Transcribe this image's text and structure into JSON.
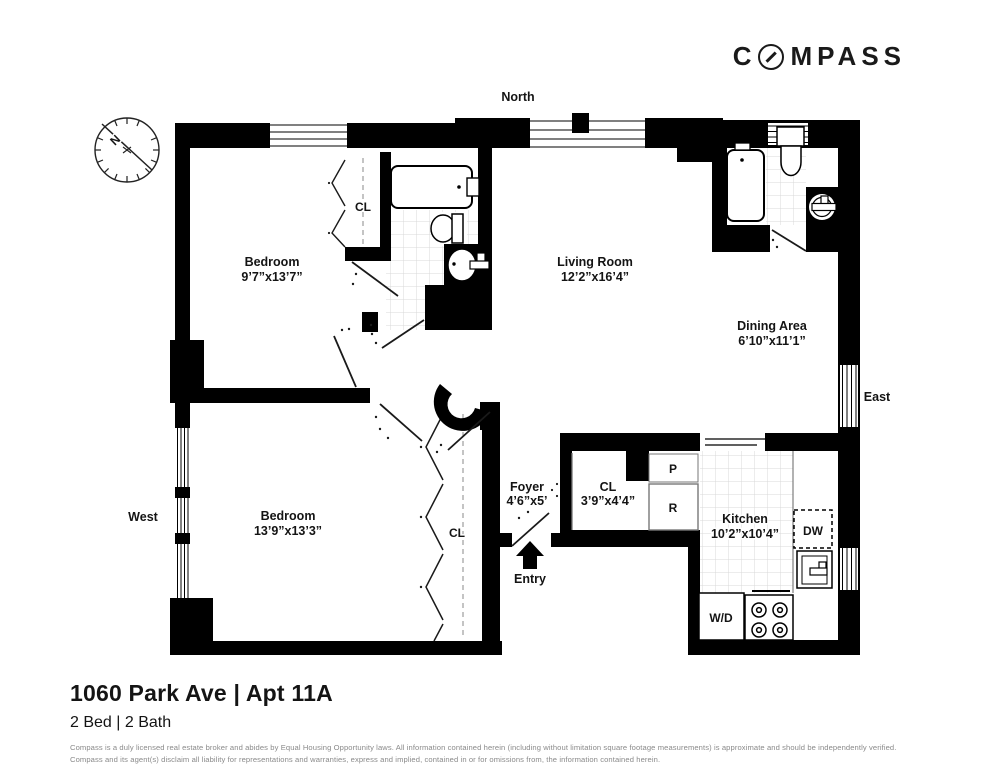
{
  "logo": {
    "part1": "C",
    "part2": "MPASS"
  },
  "plan": {
    "compass_rose": {
      "n": "N"
    },
    "directions": {
      "north": "North",
      "east": "East",
      "west": "West"
    },
    "rooms": {
      "bedroom1": {
        "name": "Bedroom",
        "dims": "9’7”x13’7”"
      },
      "bedroom2": {
        "name": "Bedroom",
        "dims": "13’9”x13’3”"
      },
      "living_room": {
        "name": "Living Room",
        "dims": "12’2”x16’4”"
      },
      "dining_area": {
        "name": "Dining Area",
        "dims": "6’10”x11’1”"
      },
      "kitchen": {
        "name": "Kitchen",
        "dims": "10’2”x10’4”"
      },
      "foyer": {
        "name": "Foyer",
        "dims": "4’6”x5’"
      },
      "hall_closet": {
        "name": "CL",
        "dims": "3’9”x4’4”"
      },
      "bedroom1_closet": {
        "name": "CL"
      },
      "bedroom2_closet": {
        "name": "CL"
      }
    },
    "labels": {
      "pantry": "P",
      "refrigerator": "R",
      "dishwasher": "DW",
      "washer_dryer": "W/D",
      "entry": "Entry"
    }
  },
  "footer": {
    "title": "1060 Park Ave | Apt 11A",
    "subtitle": "2 Bed | 2 Bath",
    "disclaimer_line1": "Compass is a duly licensed real estate broker and abides by Equal Housing Opportunity laws.  All information contained herein (including without limitation square footage measurements) is approximate and should be independently verified.",
    "disclaimer_line2": "Compass and its agent(s) disclaim all liability for representations and warranties, express and implied, contained in or for omissions from, the information contained herein."
  }
}
